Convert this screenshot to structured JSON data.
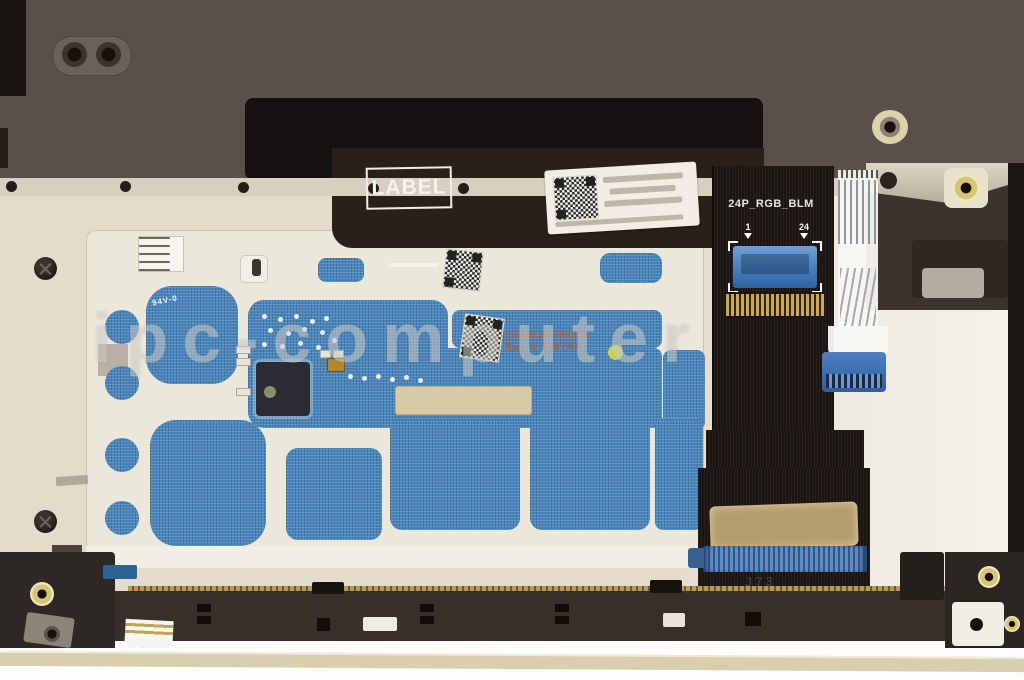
{
  "labels": {
    "label_box": "LABEL",
    "cable_connector": "24P_RGB_BLM",
    "pin_first": "1",
    "pin_last": "24",
    "pcb_part_number": "ZH2012-043301",
    "pcb_revision": "Rev.A 58974A",
    "pcb_cert": "94V-0",
    "board_silk": "J73",
    "watermark": "ipc-computer"
  },
  "colors": {
    "chassis_top": "#59504b",
    "black_patch": "#151110",
    "plate_beige": "#e3dccd",
    "plate_white": "#ebe7db",
    "pcb_blue": "#4a86bb",
    "cable_black": "#1b1411",
    "connector_blue": "#3d6fae",
    "stiffener_blue": "#5e8cc6",
    "kapton_tan": "#d6ba80",
    "gold_finger": "#c9a94e",
    "brass_insert": "#d6c070",
    "silk_orange": "#c4622f",
    "bottom_strip": "#d9cfae"
  }
}
